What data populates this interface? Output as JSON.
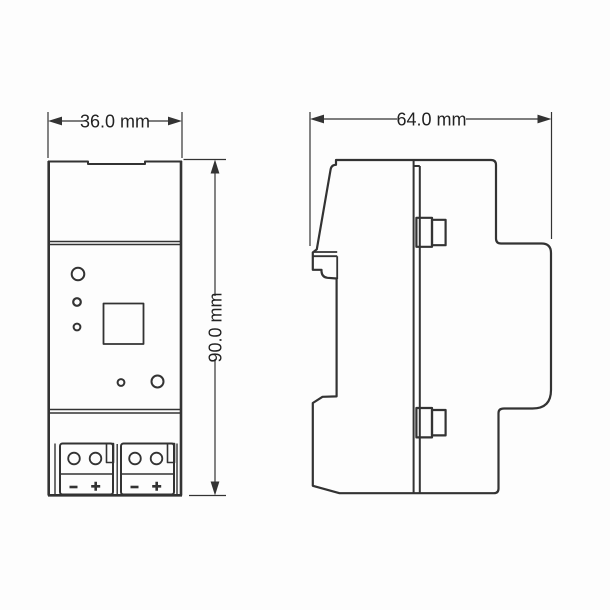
{
  "colors": {
    "background": "#fdfdfd",
    "line": "#333333",
    "text": "#222222"
  },
  "views": {
    "front": {
      "width_dimension_label": "36.0 mm",
      "height_dimension_label": "90.0 mm"
    },
    "side": {
      "width_dimension_label": "64.0 mm"
    }
  }
}
